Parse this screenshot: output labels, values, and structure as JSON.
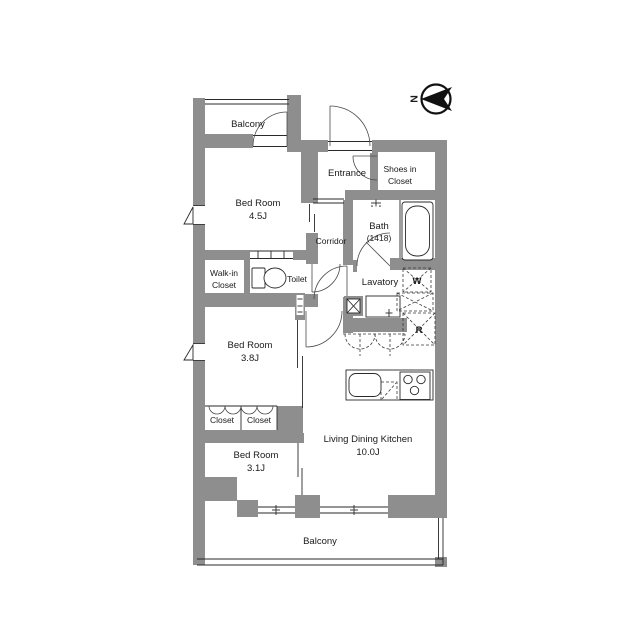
{
  "floorplan": {
    "compass": {
      "north_label": "N"
    },
    "rooms": {
      "balcony_top": "Balcony",
      "bedroom_45": {
        "name": "Bed Room",
        "size": "4.5J"
      },
      "entrance": "Entrance",
      "shoes_in_closet": {
        "line1": "Shoes in",
        "line2": "Closet"
      },
      "bath": {
        "name": "Bath",
        "size": "(1418)"
      },
      "corridor": "Corridor",
      "walk_in_closet": {
        "line1": "Walk-in",
        "line2": "Closet"
      },
      "toilet": "Toilet",
      "lavatory": "Lavatory",
      "washer": "W",
      "refrigerator": "R",
      "bedroom_38": {
        "name": "Bed Room",
        "size": "3.8J"
      },
      "closet_left": "Closet",
      "closet_right": "Closet",
      "bedroom_31": {
        "name": "Bed Room",
        "size": "3.1J"
      },
      "ldk": {
        "name": "Living Dining Kitchen",
        "size": "10.0J"
      },
      "balcony_bottom": "Balcony"
    },
    "colors": {
      "wall": "#8e8e8e",
      "line": "#2a2a2a",
      "background": "#ffffff"
    }
  }
}
